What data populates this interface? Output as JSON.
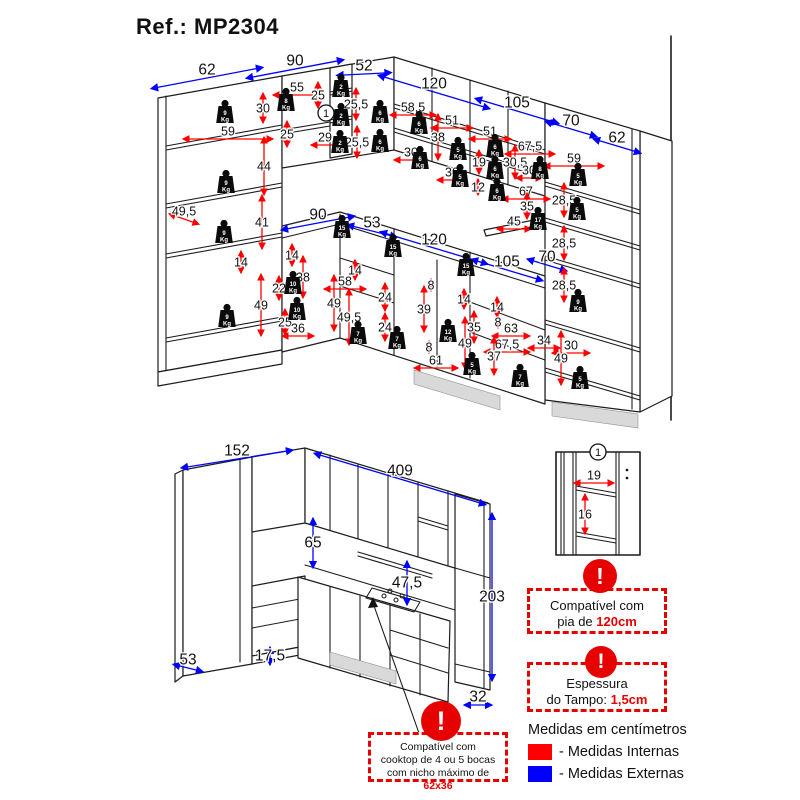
{
  "title": "Ref.: MP2304",
  "weights_unit": "Kg",
  "legend": {
    "heading": "Medidas em centímetros",
    "internal": "- Medidas Internas",
    "external": "- Medidas Externas"
  },
  "colors": {
    "internal": "#ff0000",
    "external": "#0000ff",
    "note_red": "#e60000"
  },
  "notes": {
    "warning": "!",
    "pia": {
      "lines": [
        "Compatível com",
        "pia de "
      ],
      "highlight": "120cm"
    },
    "tampo": {
      "lines": [
        "Espessura",
        "do Tampo: "
      ],
      "highlight": "1,5cm"
    },
    "cooktop": {
      "line1": "Compatível com",
      "line2": "cooktop de 4 ou 5 bocas",
      "line3": "com nicho máximo de ",
      "highlight": "62x36"
    }
  },
  "markers": [
    {
      "label": "1",
      "x": 326,
      "y": 113
    },
    {
      "label": "1",
      "x": 598,
      "y": 452
    }
  ],
  "weights": [
    {
      "kg": "9",
      "x": 225,
      "y": 112
    },
    {
      "kg": "9",
      "x": 226,
      "y": 182
    },
    {
      "kg": "9",
      "x": 224,
      "y": 232
    },
    {
      "kg": "9",
      "x": 227,
      "y": 316
    },
    {
      "kg": "8",
      "x": 286,
      "y": 100
    },
    {
      "kg": "2",
      "x": 341,
      "y": 86
    },
    {
      "kg": "2",
      "x": 341,
      "y": 115
    },
    {
      "kg": "2",
      "x": 340,
      "y": 142
    },
    {
      "kg": "6",
      "x": 380,
      "y": 112
    },
    {
      "kg": "6",
      "x": 380,
      "y": 141
    },
    {
      "kg": "6",
      "x": 419,
      "y": 123
    },
    {
      "kg": "6",
      "x": 420,
      "y": 158
    },
    {
      "kg": "5",
      "x": 458,
      "y": 149
    },
    {
      "kg": "5",
      "x": 460,
      "y": 176
    },
    {
      "kg": "6",
      "x": 495,
      "y": 146
    },
    {
      "kg": "6",
      "x": 495,
      "y": 168
    },
    {
      "kg": "6",
      "x": 497,
      "y": 190
    },
    {
      "kg": "8",
      "x": 540,
      "y": 168
    },
    {
      "kg": "17",
      "x": 538,
      "y": 219
    },
    {
      "kg": "5",
      "x": 578,
      "y": 175
    },
    {
      "kg": "5",
      "x": 577,
      "y": 209
    },
    {
      "kg": "15",
      "x": 342,
      "y": 227
    },
    {
      "kg": "15",
      "x": 393,
      "y": 246
    },
    {
      "kg": "15",
      "x": 466,
      "y": 265
    },
    {
      "kg": "10",
      "x": 293,
      "y": 283
    },
    {
      "kg": "10",
      "x": 297,
      "y": 309
    },
    {
      "kg": "7",
      "x": 358,
      "y": 333
    },
    {
      "kg": "7",
      "x": 397,
      "y": 338
    },
    {
      "kg": "7",
      "x": 520,
      "y": 376
    },
    {
      "kg": "12",
      "x": 448,
      "y": 331
    },
    {
      "kg": "9",
      "x": 578,
      "y": 301
    },
    {
      "kg": "5",
      "x": 472,
      "y": 364
    },
    {
      "kg": "5",
      "x": 580,
      "y": 378
    }
  ],
  "dimensions": [
    {
      "t": "62",
      "x": 207,
      "y": 70,
      "c": "e",
      "o": "d",
      "s": -0.19,
      "l": 112
    },
    {
      "t": "90",
      "x": 295,
      "y": 61,
      "c": "e",
      "o": "d",
      "s": -0.19,
      "l": 98
    },
    {
      "t": "52",
      "x": 364,
      "y": 66,
      "c": "e",
      "o": "d",
      "s": -0.05,
      "l": 55
    },
    {
      "t": "120",
      "x": 434,
      "y": 84,
      "c": "e",
      "o": "d",
      "s": 0.3,
      "l": 112
    },
    {
      "t": "105",
      "x": 517,
      "y": 103,
      "c": "e",
      "o": "d",
      "s": 0.3,
      "l": 84
    },
    {
      "t": "70",
      "x": 571,
      "y": 121,
      "c": "e",
      "o": "d",
      "s": 0.3,
      "l": 52
    },
    {
      "t": "62",
      "x": 617,
      "y": 138,
      "c": "e",
      "o": "d",
      "s": 0.3,
      "l": 48
    },
    {
      "t": "90",
      "x": 318,
      "y": 215,
      "c": "e",
      "o": "d",
      "s": -0.19,
      "l": 74
    },
    {
      "t": "53",
      "x": 372,
      "y": 223,
      "c": "e",
      "o": "d",
      "s": 0.25,
      "l": 50
    },
    {
      "t": "120",
      "x": 434,
      "y": 240,
      "c": "e",
      "o": "d",
      "s": 0.3,
      "l": 108
    },
    {
      "t": "105",
      "x": 507,
      "y": 262,
      "c": "e",
      "o": "d",
      "s": 0.3,
      "l": 72
    },
    {
      "t": "70",
      "x": 547,
      "y": 257,
      "c": "e",
      "o": "d",
      "s": 0.3,
      "l": 40
    },
    {
      "t": "49,5",
      "x": 184,
      "y": 211,
      "c": "i",
      "o": "d",
      "s": 0.35,
      "l": 30
    },
    {
      "t": "59",
      "x": 228,
      "y": 131,
      "c": "i",
      "o": "h",
      "l": 90
    },
    {
      "t": "30",
      "x": 263,
      "y": 108,
      "c": "i",
      "o": "v",
      "l": 30
    },
    {
      "t": "44",
      "x": 264,
      "y": 166,
      "c": "i",
      "o": "v",
      "l": 58
    },
    {
      "t": "41",
      "x": 262,
      "y": 222,
      "c": "i",
      "o": "v",
      "l": 54
    },
    {
      "t": "14",
      "x": 241,
      "y": 262,
      "c": "i",
      "o": "v",
      "l": 22
    },
    {
      "t": "49",
      "x": 261,
      "y": 305,
      "c": "i",
      "o": "v",
      "l": 62
    },
    {
      "t": "55",
      "x": 297,
      "y": 87,
      "c": "i",
      "o": "h",
      "l": 48
    },
    {
      "t": "25",
      "x": 318,
      "y": 95,
      "c": "i",
      "o": "v",
      "l": 26
    },
    {
      "t": "25",
      "x": 287,
      "y": 134,
      "c": "i",
      "o": "v",
      "l": 26
    },
    {
      "t": "29",
      "x": 325,
      "y": 137,
      "c": "i",
      "o": "h",
      "l": 28
    },
    {
      "t": "25,5",
      "x": 356,
      "y": 104,
      "c": "i",
      "o": "v",
      "l": 32
    },
    {
      "t": "25,5",
      "x": 357,
      "y": 142,
      "c": "i",
      "o": "v",
      "l": 32
    },
    {
      "t": "58,5",
      "x": 413,
      "y": 107,
      "c": "i",
      "o": "h",
      "l": 46
    },
    {
      "t": "51",
      "x": 452,
      "y": 120,
      "c": "i",
      "o": "h",
      "l": 42
    },
    {
      "t": "51",
      "x": 490,
      "y": 131,
      "c": "i",
      "o": "h",
      "l": 42
    },
    {
      "t": "38",
      "x": 438,
      "y": 137,
      "c": "i",
      "o": "v",
      "l": 46
    },
    {
      "t": "30",
      "x": 411,
      "y": 152,
      "c": "i",
      "o": "h",
      "l": 34
    },
    {
      "t": "30",
      "x": 452,
      "y": 172,
      "c": "i",
      "o": "h",
      "l": 30
    },
    {
      "t": "19",
      "x": 479,
      "y": 162,
      "c": "i",
      "o": "v",
      "l": 24
    },
    {
      "t": "12",
      "x": 478,
      "y": 187,
      "c": "i",
      "o": "v",
      "l": 16
    },
    {
      "t": "30,5",
      "x": 515,
      "y": 162,
      "c": "i",
      "o": "v",
      "l": 34
    },
    {
      "t": "30",
      "x": 529,
      "y": 170,
      "c": "i",
      "o": "h",
      "l": 26
    },
    {
      "t": "67,5",
      "x": 530,
      "y": 146,
      "c": "i",
      "o": "h",
      "l": 50
    },
    {
      "t": "67",
      "x": 526,
      "y": 191,
      "c": "i",
      "o": "h",
      "l": 48
    },
    {
      "t": "35",
      "x": 527,
      "y": 206,
      "c": "i",
      "o": "v",
      "l": 26
    },
    {
      "t": "45",
      "x": 514,
      "y": 221,
      "c": "i",
      "o": "h",
      "l": 34
    },
    {
      "t": "59",
      "x": 574,
      "y": 158,
      "c": "i",
      "o": "h",
      "l": 60
    },
    {
      "t": "28,5",
      "x": 564,
      "y": 200,
      "c": "i",
      "o": "v",
      "l": 34
    },
    {
      "t": "28,5",
      "x": 564,
      "y": 243,
      "c": "i",
      "o": "v",
      "l": 34
    },
    {
      "t": "28,5",
      "x": 564,
      "y": 285,
      "c": "i",
      "o": "v",
      "l": 34
    },
    {
      "t": "30",
      "x": 571,
      "y": 345,
      "c": "i",
      "o": "h",
      "l": 38
    },
    {
      "t": "34",
      "x": 544,
      "y": 340,
      "c": "i",
      "o": "h",
      "l": 32
    },
    {
      "t": "49",
      "x": 561,
      "y": 358,
      "c": "i",
      "o": "v",
      "l": 54
    },
    {
      "t": "14",
      "x": 497,
      "y": 307,
      "c": "i",
      "o": "v",
      "l": 20
    },
    {
      "t": "8",
      "x": 498,
      "y": 322,
      "c": "i",
      "o": "v",
      "l": 12
    },
    {
      "t": "63",
      "x": 511,
      "y": 328,
      "c": "i",
      "o": "h",
      "l": 38
    },
    {
      "t": "67,5",
      "x": 507,
      "y": 344,
      "c": "i",
      "o": "h",
      "l": 46
    },
    {
      "t": "37",
      "x": 494,
      "y": 356,
      "c": "i",
      "o": "v",
      "l": 38
    },
    {
      "t": "14",
      "x": 292,
      "y": 255,
      "c": "i",
      "o": "v",
      "l": 22
    },
    {
      "t": "38",
      "x": 303,
      "y": 277,
      "c": "i",
      "o": "v",
      "l": 42
    },
    {
      "t": "22",
      "x": 279,
      "y": 288,
      "c": "i",
      "o": "v",
      "l": 24
    },
    {
      "t": "25",
      "x": 285,
      "y": 322,
      "c": "i",
      "o": "v",
      "l": 26
    },
    {
      "t": "36",
      "x": 298,
      "y": 328,
      "c": "i",
      "o": "h",
      "l": 32
    },
    {
      "t": "58",
      "x": 345,
      "y": 281,
      "c": "i",
      "o": "h",
      "l": 42
    },
    {
      "t": "49",
      "x": 334,
      "y": 303,
      "c": "i",
      "o": "v",
      "l": 56
    },
    {
      "t": "49,5",
      "x": 349,
      "y": 317,
      "c": "i",
      "o": "v",
      "l": 56
    },
    {
      "t": "14",
      "x": 355,
      "y": 270,
      "c": "i",
      "o": "v",
      "l": 20
    },
    {
      "t": "24",
      "x": 385,
      "y": 297,
      "c": "i",
      "o": "v",
      "l": 28
    },
    {
      "t": "24",
      "x": 385,
      "y": 327,
      "c": "i",
      "o": "v",
      "l": 28
    },
    {
      "t": "8",
      "x": 431,
      "y": 285,
      "c": "i",
      "o": "v",
      "l": 12
    },
    {
      "t": "39",
      "x": 424,
      "y": 309,
      "c": "i",
      "o": "v",
      "l": 46
    },
    {
      "t": "14",
      "x": 464,
      "y": 299,
      "c": "i",
      "o": "v",
      "l": 20
    },
    {
      "t": "35",
      "x": 474,
      "y": 327,
      "c": "i",
      "o": "v",
      "l": 32
    },
    {
      "t": "49",
      "x": 465,
      "y": 343,
      "c": "i",
      "o": "v",
      "l": 52
    },
    {
      "t": "8",
      "x": 429,
      "y": 347,
      "c": "i",
      "o": "v",
      "l": 12
    },
    {
      "t": "61",
      "x": 436,
      "y": 360,
      "c": "i",
      "o": "h",
      "l": 44
    },
    {
      "t": "152",
      "x": 237,
      "y": 451,
      "c": "e",
      "o": "d",
      "s": -0.16,
      "l": 112
    },
    {
      "t": "409",
      "x": 400,
      "y": 471,
      "c": "e",
      "o": "d",
      "s": 0.3,
      "l": 172
    },
    {
      "t": "65",
      "x": 313,
      "y": 543,
      "c": "e",
      "o": "v",
      "l": 50
    },
    {
      "t": "47,5",
      "x": 407,
      "y": 583,
      "c": "e",
      "o": "v",
      "l": 44
    },
    {
      "t": "203",
      "x": 492,
      "y": 597,
      "c": "e",
      "o": "v",
      "l": 168
    },
    {
      "t": "53",
      "x": 188,
      "y": 660,
      "c": "e",
      "o": "d",
      "s": 0.25,
      "l": 30
    },
    {
      "t": "17,5",
      "x": 270,
      "y": 656,
      "c": "e",
      "o": "v",
      "l": 18
    },
    {
      "t": "32",
      "x": 478,
      "y": 697,
      "c": "e",
      "o": "h",
      "l": 28
    },
    {
      "t": "19",
      "x": 594,
      "y": 475,
      "c": "i",
      "o": "h",
      "l": 40
    },
    {
      "t": "16",
      "x": 585,
      "y": 514,
      "c": "i",
      "o": "v",
      "l": 40
    }
  ]
}
